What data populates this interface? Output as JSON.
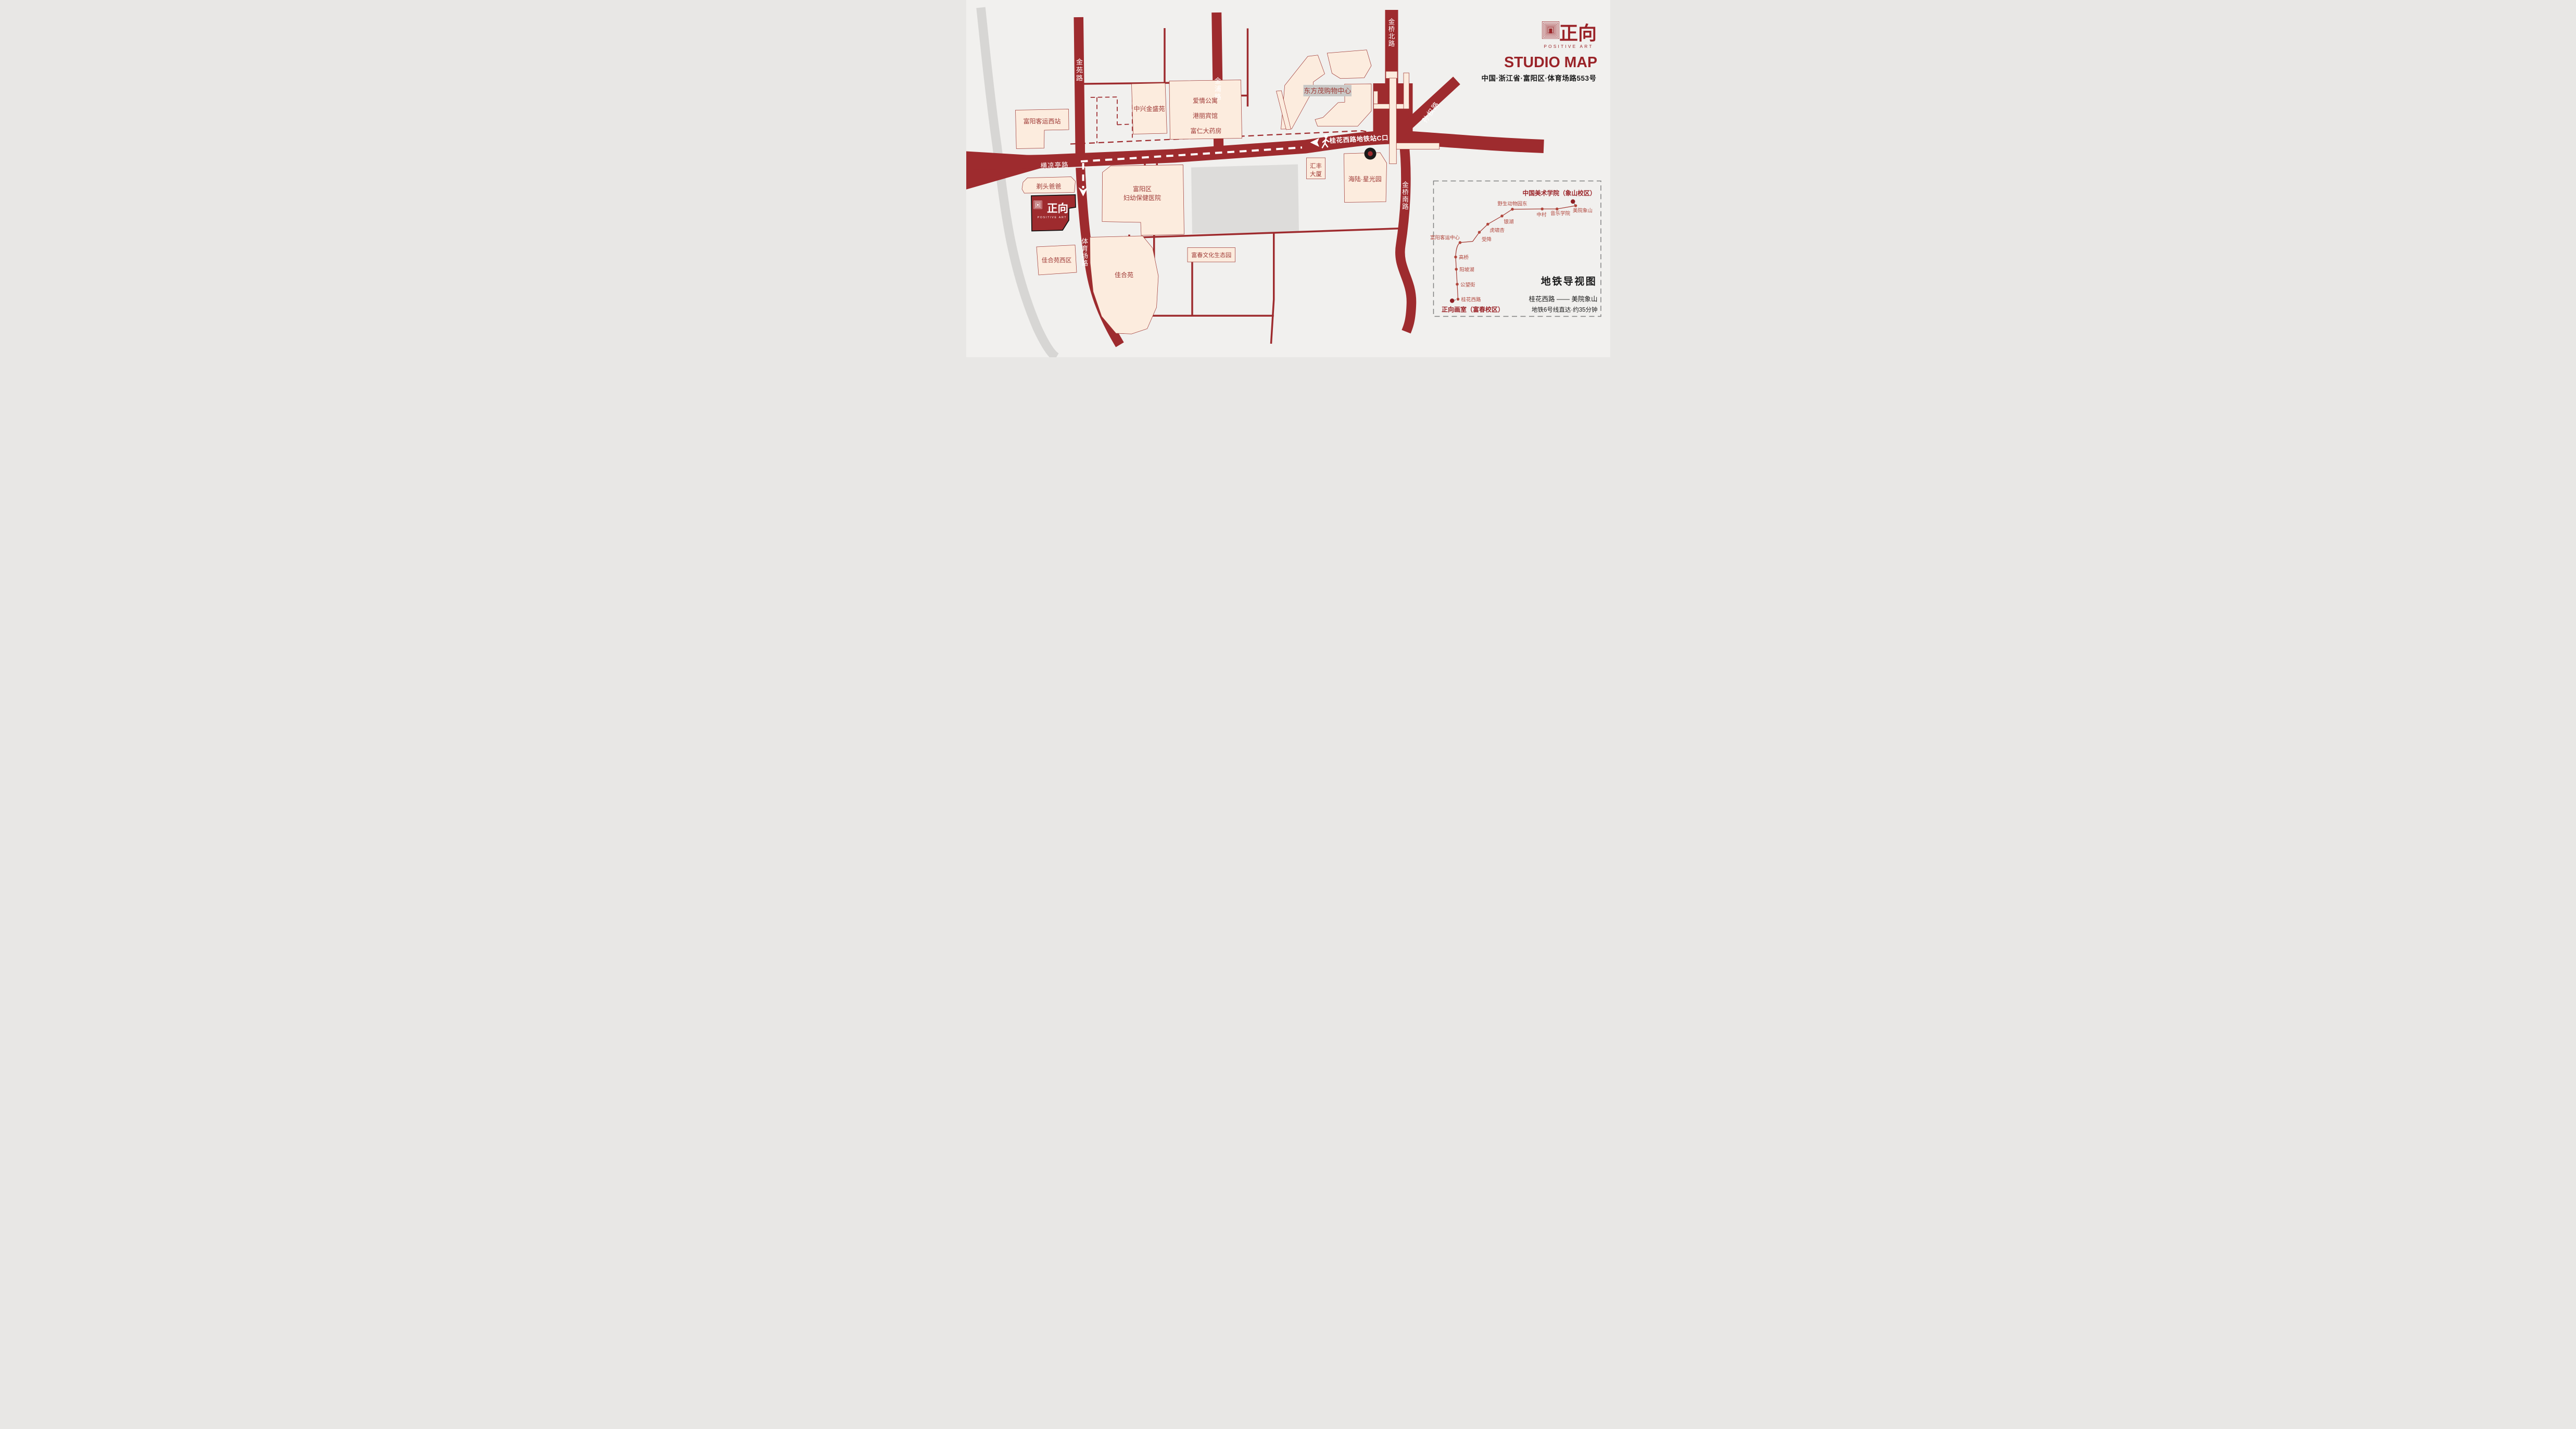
{
  "header": {
    "brand_cn": "正向",
    "brand_en": "POSITIVE ART",
    "title": "STUDIO MAP",
    "address": "中国·浙江省·富阳区·体育场路553号"
  },
  "map": {
    "roads": {
      "jinyuan": "金苑路",
      "jinpu": "金浦路",
      "jinqiao_north": "金桥北路",
      "sunquan": "孙权路",
      "jinqiao_south": "金桥南路",
      "hengliangting": "横凉亭路",
      "tiyuchang": "体育场路"
    },
    "metro_exit_label": "桂花西路地铁站C口",
    "places": {
      "bus_west_station": "富阳客运西站",
      "zhongxing": "中兴金盛苑",
      "apartment": "爱情公寓",
      "hotel": "港丽宾馆",
      "pharmacy": "富仁大药房",
      "mall": "东方茂购物中心",
      "huifeng_line1": "汇丰",
      "huifeng_line2": "大厦",
      "hailu": "海陆·星光园",
      "hospital_line1": "富阳区",
      "hospital_line2": "妇幼保健医院",
      "barber": "剃头爸爸",
      "jiaheyuan_west": "佳合苑西区",
      "jiaheyuan": "佳合苑",
      "eco_park": "富春文化生态园"
    },
    "studio_marker": {
      "brand_cn": "正向",
      "brand_en": "POSITIVE ART"
    }
  },
  "legend": {
    "title": "地铁导视图",
    "destination": "中国美术学院（象山校区）",
    "origin": "正向画室（富春校区）",
    "route": "桂花西路 —— 美院象山",
    "note": "地铁6号线直达·约35分钟",
    "stations": [
      {
        "name": "桂花西路"
      },
      {
        "name": "公望街"
      },
      {
        "name": "阳坡湖"
      },
      {
        "name": "高桥"
      },
      {
        "name": "富阳客运中心"
      },
      {
        "name": "受降"
      },
      {
        "name": "虎啸杏"
      },
      {
        "name": "银湖"
      },
      {
        "name": "野生动物园东"
      },
      {
        "name": "中村"
      },
      {
        "name": "音乐学院"
      },
      {
        "name": "美院象山"
      }
    ]
  },
  "colors": {
    "road_red": "#9E2B2E",
    "building_cream": "#FCECDE",
    "building_outline": "#9F3A36",
    "background": "#F1F0EE",
    "river_gray": "#D7D6D4",
    "block_gray": "#DDDCDA",
    "label_chip_gray": "#C9C8C6",
    "ink_black": "#1A1A1A",
    "brand_red": "#9A2328",
    "metro_line": "#A43C35",
    "station_dot": "#B1463C",
    "terminal_dot": "#8E2025"
  }
}
